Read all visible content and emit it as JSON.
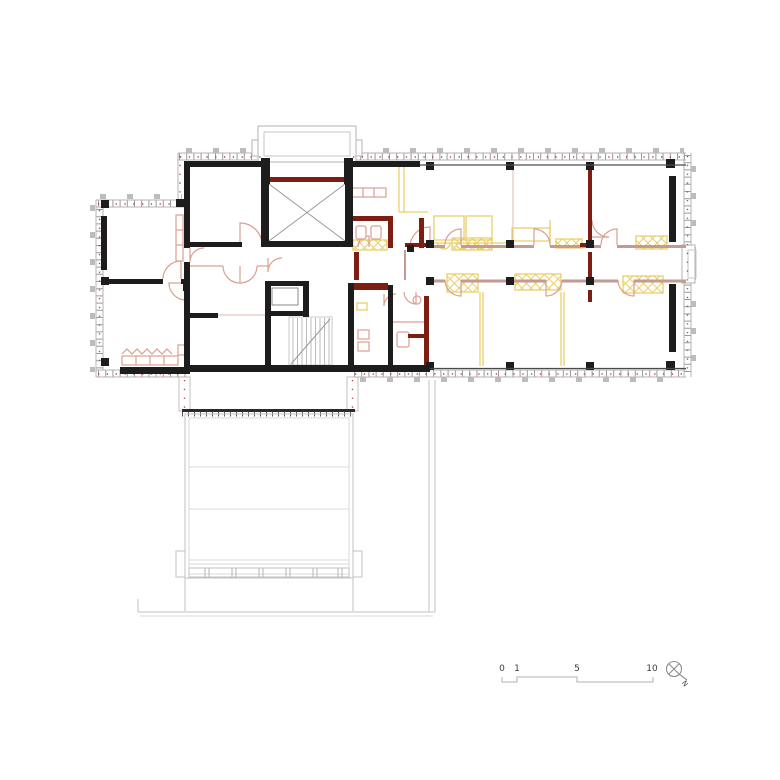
{
  "scale_bar": {
    "labels": [
      "0",
      "1",
      "5",
      "10"
    ]
  },
  "compass": {
    "label": "N"
  },
  "colors": {
    "background": "#ffffff",
    "existing_wall": "#1d1d1d",
    "new_wall": "#7e1d11",
    "furniture_yellow": "#e9cf6a",
    "fixture_salmon": "#d9a091",
    "partition_mauve": "#c49a94",
    "facade_gray": "#b3b3b3",
    "annex_gray": "#c2c2c2",
    "marker_red": "#c0473c"
  }
}
